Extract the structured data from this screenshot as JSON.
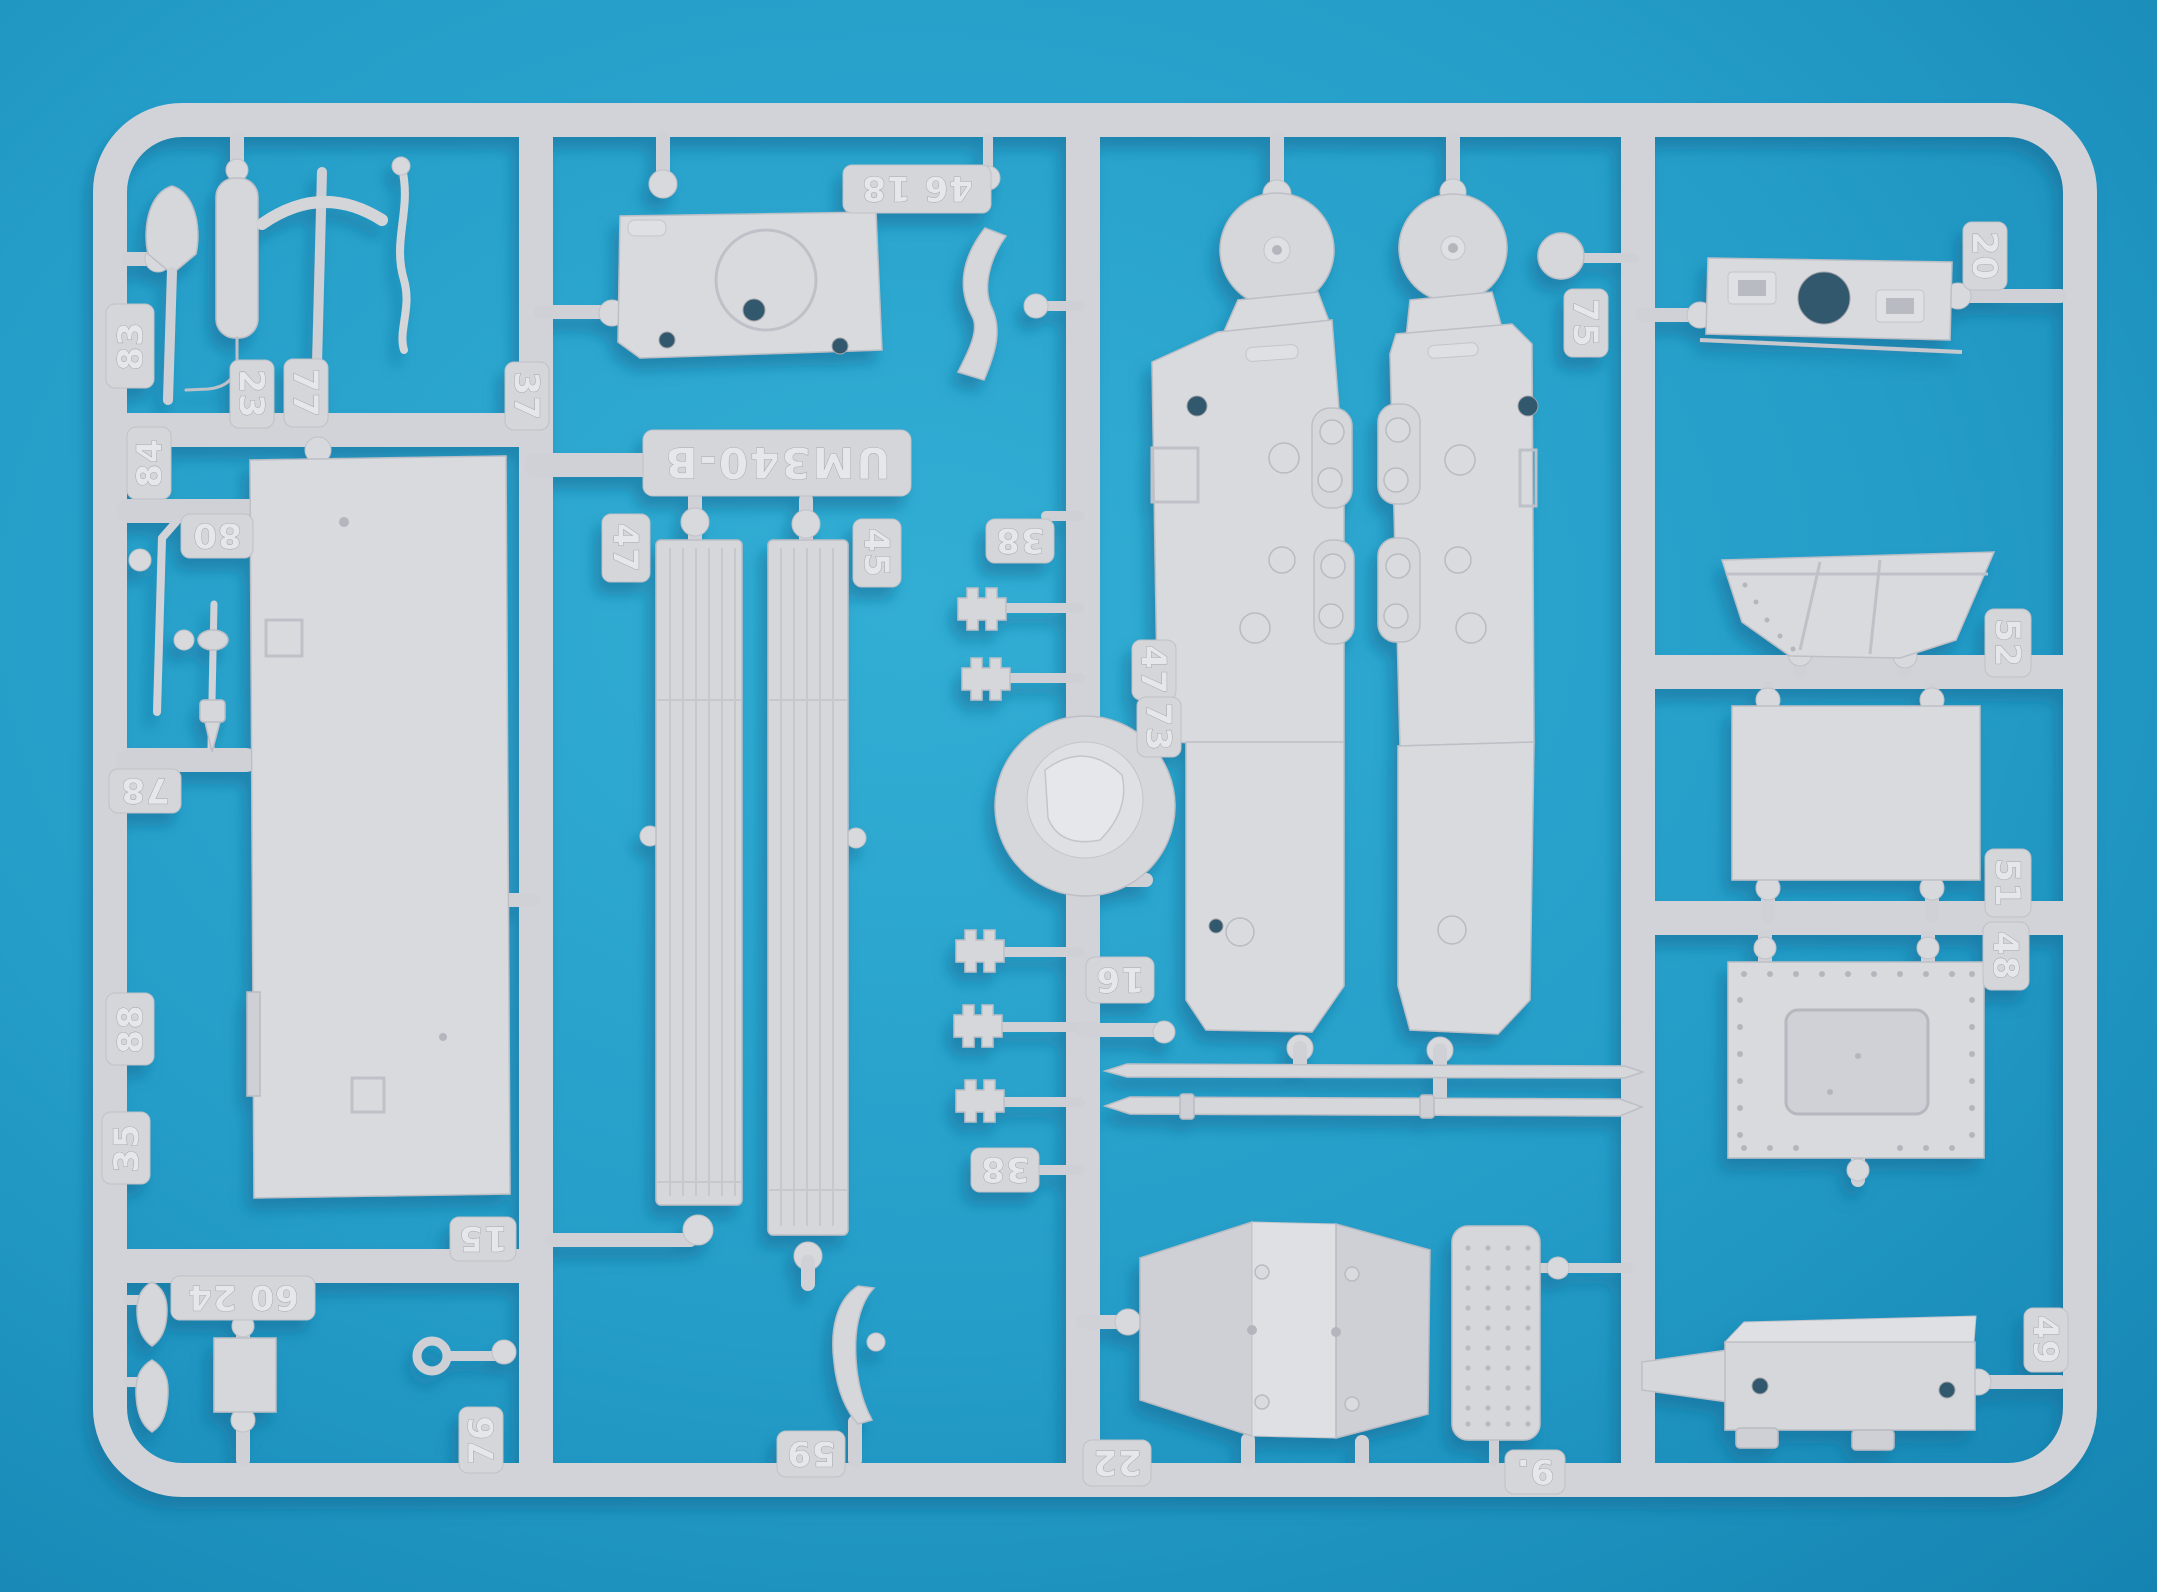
{
  "scene": {
    "type": "photograph",
    "subject": "Injection-molded model kit sprue (white styrene parts tree) lying on a cyan-blue background",
    "kit_code": "UM340-B"
  },
  "colors": {
    "background_center": "#2fabd1",
    "background_edge": "#1583b1",
    "plastic_base": "#d4d5d9",
    "plastic_highlight": "#e2e3e7",
    "plastic_shadow": "#b8bac1",
    "cast_shadow": "#0c6d96",
    "hole_dark": "#33596e"
  },
  "part_labels": [
    {
      "id": "tab-83",
      "text": "83"
    },
    {
      "id": "tab-84",
      "text": "84"
    },
    {
      "id": "tab-80",
      "text": "80"
    },
    {
      "id": "tab-78",
      "text": "78"
    },
    {
      "id": "tab-88",
      "text": "88"
    },
    {
      "id": "tab-35",
      "text": "35"
    },
    {
      "id": "tab-23",
      "text": "23"
    },
    {
      "id": "tab-77",
      "text": "77"
    },
    {
      "id": "tab-37",
      "text": "37"
    },
    {
      "id": "tab-46-18",
      "text": "46 18"
    },
    {
      "id": "plate-um340-b",
      "text": "UM340-B"
    },
    {
      "id": "tab-47-planks",
      "text": "47"
    },
    {
      "id": "tab-45",
      "text": "45"
    },
    {
      "id": "tab-38-top",
      "text": "38"
    },
    {
      "id": "tab-38-bottom",
      "text": "38"
    },
    {
      "id": "tab-16",
      "text": "16"
    },
    {
      "id": "tab-47-hull",
      "text": "47"
    },
    {
      "id": "tab-73",
      "text": "73"
    },
    {
      "id": "tab-20",
      "text": "20"
    },
    {
      "id": "tab-75",
      "text": "75"
    },
    {
      "id": "tab-52",
      "text": "52"
    },
    {
      "id": "tab-51",
      "text": "51"
    },
    {
      "id": "tab-48",
      "text": "48"
    },
    {
      "id": "tab-49",
      "text": "49"
    },
    {
      "id": "tab-15",
      "text": "15"
    },
    {
      "id": "tab-76",
      "text": "76"
    },
    {
      "id": "tab-60-24",
      "text": "60 24"
    },
    {
      "id": "tab-59",
      "text": "59"
    },
    {
      "id": "tab-22",
      "text": "22"
    },
    {
      "id": "tab-9",
      "text": "9."
    }
  ]
}
